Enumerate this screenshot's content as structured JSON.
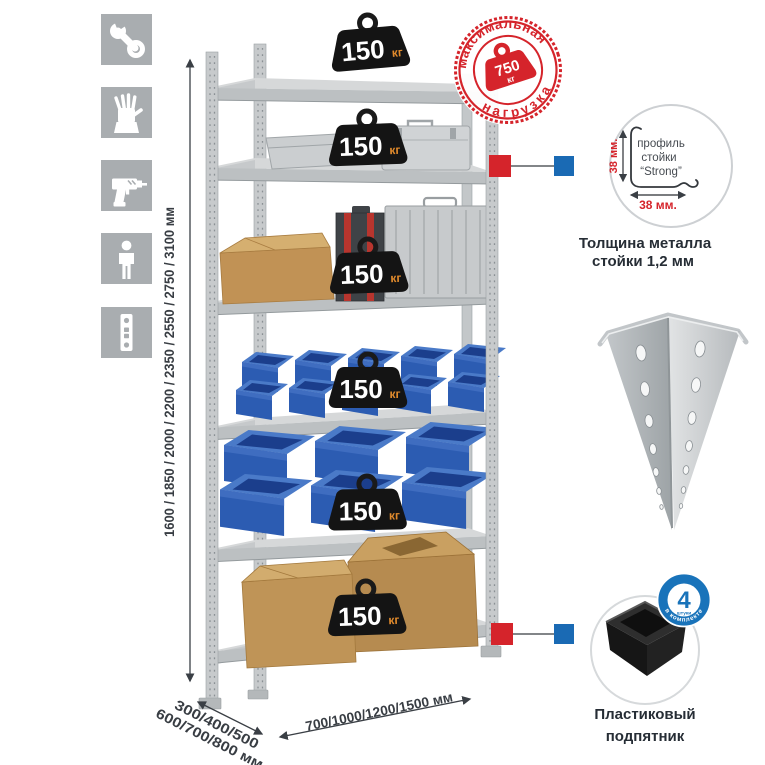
{
  "sidebar_icons": [
    "wrench",
    "gloves",
    "drill",
    "person",
    "rack-profile"
  ],
  "dimensions": {
    "height_label": "1600 / 1850 / 2000 / 2200 / 2350 / 2550 / 2750 / 3100 мм",
    "depth_label_line1": "300/400/500",
    "depth_label_line2": "600/700/800 мм",
    "width_label": "700/1000/1200/1500 мм"
  },
  "shelf_weight": {
    "value": "150",
    "unit": "кг"
  },
  "max_load_stamp": {
    "arc_top": "максимальная",
    "arc_bottom": "нагрузка",
    "value": "750",
    "unit": "кг"
  },
  "profile_detail": {
    "label_line1": "профиль",
    "label_line2": "стойки",
    "label_line3": "“Strong”",
    "vertical_dim": "38 мм.",
    "horizontal_dim": "38 мм.",
    "caption_line1": "Толщина металла",
    "caption_line2": "стойки 1,2 мм"
  },
  "foot_detail": {
    "badge_number": "4",
    "badge_word": "штуки",
    "badge_arc": "в комплекте",
    "caption_line1": "Пластиковый",
    "caption_line2": "подпятник"
  },
  "colors": {
    "accent_red": "#d5242b",
    "accent_blue": "#1a6ab4",
    "bin_blue": "#2c5cb2",
    "icon_gray": "#a9adb0"
  }
}
